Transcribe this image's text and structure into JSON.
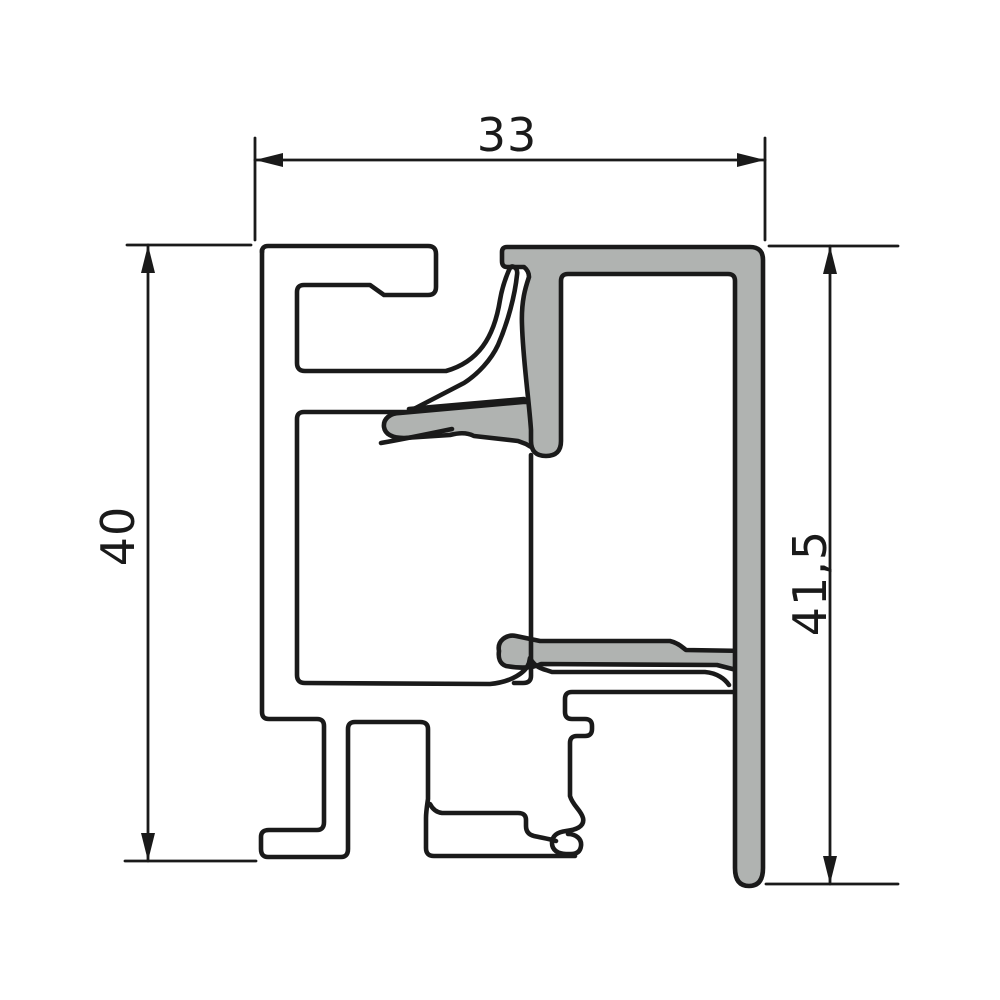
{
  "diagram": {
    "type": "aluminium-profile-cross-section",
    "labels": {
      "top_width": "33",
      "left_height": "40",
      "right_height": "41,5"
    },
    "colors": {
      "line": "#1a1a1a",
      "bead_fill": "#b0b3b1",
      "background": "#ffffff"
    }
  }
}
